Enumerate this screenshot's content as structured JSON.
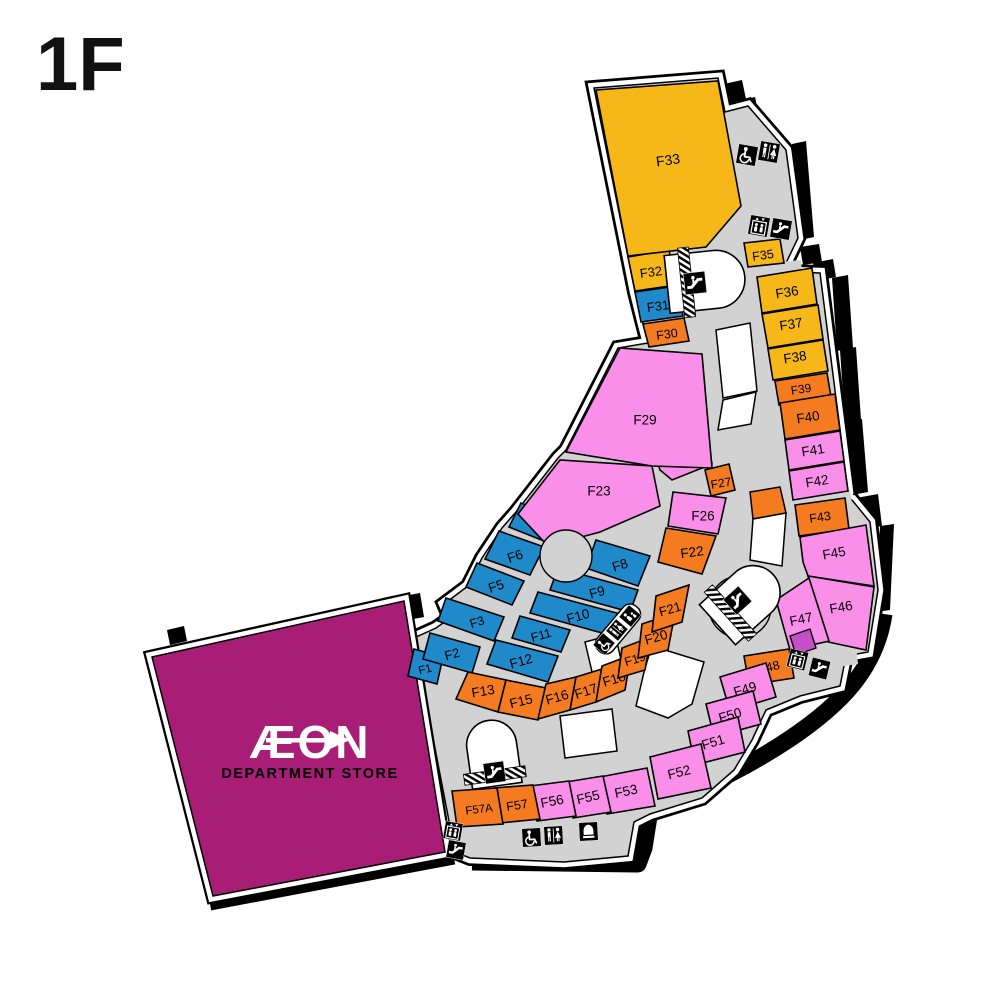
{
  "page": {
    "floor_label": "1F"
  },
  "colors": {
    "yellow": "#F6B719",
    "orange": "#F47B20",
    "blue": "#2089C9",
    "pink": "#F98FE9",
    "magenta": "#A81E76",
    "corridor": "#D2D2D3",
    "kiosk": "#FFFFFF",
    "outline": "#000000"
  },
  "anchor": {
    "name": "AEON Department Store",
    "logo_text": "ÆON",
    "subtitle": "DEPARTMENT STORE"
  },
  "units": [
    {
      "id": "F1",
      "label": "F1",
      "color": "blue"
    },
    {
      "id": "F2",
      "label": "F2",
      "color": "blue"
    },
    {
      "id": "F3",
      "label": "F3",
      "color": "blue"
    },
    {
      "id": "F5",
      "label": "F5",
      "color": "blue"
    },
    {
      "id": "F6",
      "label": "F6",
      "color": "blue"
    },
    {
      "id": "F7",
      "label": "F7",
      "color": "blue"
    },
    {
      "id": "F8",
      "label": "F8",
      "color": "blue"
    },
    {
      "id": "F9",
      "label": "F9",
      "color": "blue"
    },
    {
      "id": "F10",
      "label": "F10",
      "color": "blue"
    },
    {
      "id": "F11",
      "label": "F11",
      "color": "blue"
    },
    {
      "id": "F12",
      "label": "F12",
      "color": "blue"
    },
    {
      "id": "F13",
      "label": "F13",
      "color": "orange"
    },
    {
      "id": "F15",
      "label": "F15",
      "color": "orange"
    },
    {
      "id": "F16",
      "label": "F16",
      "color": "orange"
    },
    {
      "id": "F17",
      "label": "F17",
      "color": "orange"
    },
    {
      "id": "F18",
      "label": "F18",
      "color": "orange"
    },
    {
      "id": "F19",
      "label": "F19",
      "color": "orange"
    },
    {
      "id": "F20",
      "label": "F20",
      "color": "orange"
    },
    {
      "id": "F21",
      "label": "F21",
      "color": "orange"
    },
    {
      "id": "F22",
      "label": "F22",
      "color": "orange"
    },
    {
      "id": "F23",
      "label": "F23",
      "color": "pink"
    },
    {
      "id": "F26",
      "label": "F26",
      "color": "pink"
    },
    {
      "id": "F27",
      "label": "F27",
      "color": "orange"
    },
    {
      "id": "F28",
      "label": "F28",
      "color": "pink"
    },
    {
      "id": "F29",
      "label": "F29",
      "color": "pink"
    },
    {
      "id": "F30",
      "label": "F30",
      "color": "orange"
    },
    {
      "id": "F31",
      "label": "F31",
      "color": "blue"
    },
    {
      "id": "F32",
      "label": "F32",
      "color": "yellow"
    },
    {
      "id": "F33",
      "label": "F33",
      "color": "yellow"
    },
    {
      "id": "F35",
      "label": "F35",
      "color": "yellow"
    },
    {
      "id": "F36",
      "label": "F36",
      "color": "yellow"
    },
    {
      "id": "F37",
      "label": "F37",
      "color": "yellow"
    },
    {
      "id": "F38",
      "label": "F38",
      "color": "yellow"
    },
    {
      "id": "F39",
      "label": "F39",
      "color": "orange"
    },
    {
      "id": "F40",
      "label": "F40",
      "color": "orange"
    },
    {
      "id": "F41",
      "label": "F41",
      "color": "pink"
    },
    {
      "id": "F42",
      "label": "F42",
      "color": "pink"
    },
    {
      "id": "F43",
      "label": "F43",
      "color": "orange"
    },
    {
      "id": "F45",
      "label": "F45",
      "color": "pink"
    },
    {
      "id": "F46",
      "label": "F46",
      "color": "pink"
    },
    {
      "id": "F47",
      "label": "F47",
      "color": "pink"
    },
    {
      "id": "F48",
      "label": "F48",
      "color": "orange"
    },
    {
      "id": "F49",
      "label": "F49",
      "color": "pink"
    },
    {
      "id": "F50",
      "label": "F50",
      "color": "pink"
    },
    {
      "id": "F51",
      "label": "F51",
      "color": "pink"
    },
    {
      "id": "F52",
      "label": "F52",
      "color": "pink"
    },
    {
      "id": "F53",
      "label": "F53",
      "color": "pink"
    },
    {
      "id": "F55",
      "label": "F55",
      "color": "pink"
    },
    {
      "id": "F56",
      "label": "F56",
      "color": "pink"
    },
    {
      "id": "F57",
      "label": "F57",
      "color": "orange"
    },
    {
      "id": "F57A",
      "label": "F57A",
      "color": "orange"
    }
  ],
  "icons": [
    {
      "id": "wheelchair-top",
      "type": "wheelchair"
    },
    {
      "id": "toilets-top",
      "type": "toilets"
    },
    {
      "id": "elevator-top",
      "type": "elevator"
    },
    {
      "id": "escalator-top",
      "type": "escalator"
    },
    {
      "id": "escalator-upper-core",
      "type": "escalator"
    },
    {
      "id": "wheelchair-mid",
      "type": "wheelchair"
    },
    {
      "id": "toilets-mid",
      "type": "toilets"
    },
    {
      "id": "nursing-mid",
      "type": "nursing"
    },
    {
      "id": "escalator-mid-core",
      "type": "escalator"
    },
    {
      "id": "elevator-right",
      "type": "elevator"
    },
    {
      "id": "escalator-right",
      "type": "escalator"
    },
    {
      "id": "elevator-bottom",
      "type": "elevator"
    },
    {
      "id": "escalator-bottom",
      "type": "escalator"
    },
    {
      "id": "wheelchair-bottom",
      "type": "wheelchair"
    },
    {
      "id": "toilets-bottom",
      "type": "toilets"
    },
    {
      "id": "prayer-room-bottom",
      "type": "prayer"
    },
    {
      "id": "escalator-lower-core",
      "type": "escalator"
    }
  ]
}
